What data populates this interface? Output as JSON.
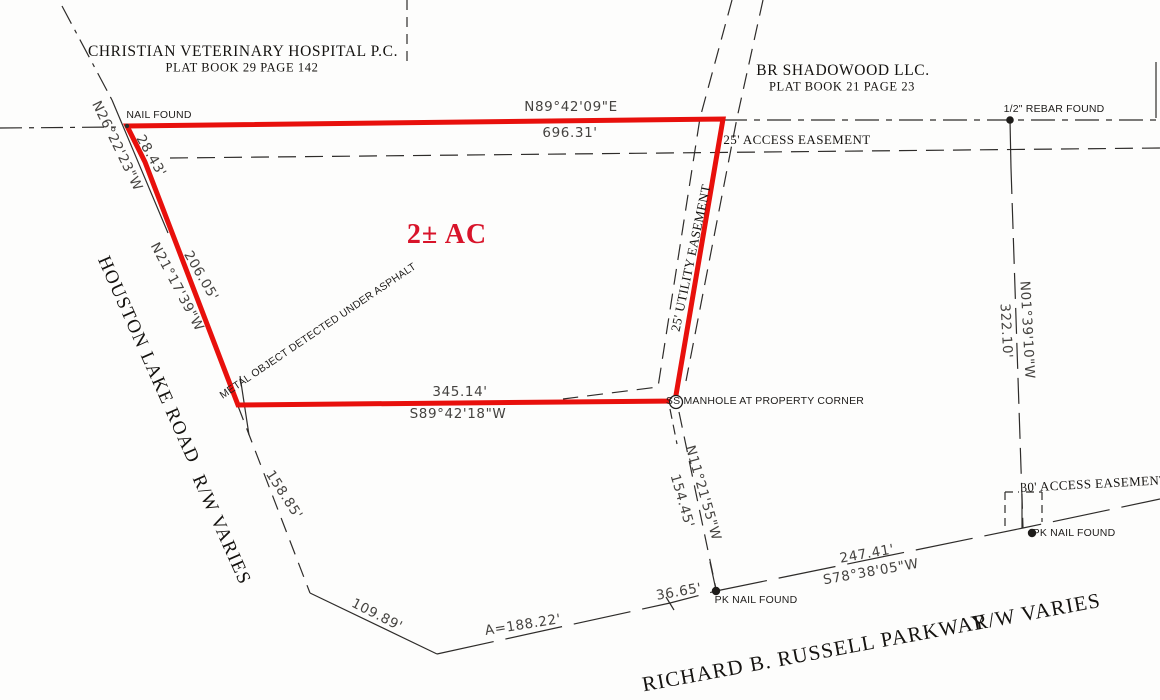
{
  "adjoiners": {
    "north": {
      "name": "CHRISTIAN VETERINARY HOSPITAL P.C.",
      "plat": "PLAT  BOOK 29  PAGE 142"
    },
    "northeast": {
      "name": "BR SHADOWOOD LLC.",
      "plat": "PLAT  BOOK 21  PAGE 23"
    }
  },
  "parcel": {
    "area": "2± AC",
    "boundaries": {
      "north": {
        "bearing": "N89°42'09\"E",
        "distance": "696.31'"
      },
      "west_upper": {
        "bearing": "N26°22'23\"W",
        "distance": "28.43'"
      },
      "west": {
        "bearing": "N21°17'39\"W",
        "distance": "206.05'"
      },
      "south": {
        "bearing": "S89°42'18\"W",
        "distance": "345.14'"
      }
    }
  },
  "ties": {
    "southeast": {
      "bearing": "N11°21'55\"W",
      "distance": "154.45'"
    },
    "east": {
      "bearing": "N01°39'10\"W",
      "distance": "322.10'"
    },
    "road_arc": "A=188.22'",
    "road_segment": "36.65'",
    "parkway": {
      "bearing": "S78°38'05\"W",
      "distance": "247.41'"
    },
    "houston_upper": "158.85'",
    "houston_lower": "109.89'"
  },
  "easements": {
    "access_25": "25' ACCESS EASEMENT",
    "utility_25": "25' UTILITY EASEMENT",
    "access_30": "30' ACCESS EASEMENT"
  },
  "monuments": {
    "nail": "NAIL FOUND",
    "rebar": "1/2\" REBAR FOUND",
    "pk_nail_south": "PK NAIL FOUND",
    "pk_nail_east": "PK NAIL FOUND",
    "manhole": "SS MANHOLE AT PROPERTY CORNER"
  },
  "notes": {
    "metal_object": "METAL OBJECT DETECTED UNDER ASPHALT"
  },
  "roads": {
    "houston": {
      "name": "HOUSTON LAKE ROAD",
      "rw": "R/W VARIES"
    },
    "russell": {
      "name": "RICHARD B. RUSSELL PARKWAY",
      "rw": "R/W VARIES"
    }
  },
  "colors": {
    "boundary_red": "#e8100c",
    "label_red": "#d8142a",
    "line_black": "#2e2c2a"
  }
}
